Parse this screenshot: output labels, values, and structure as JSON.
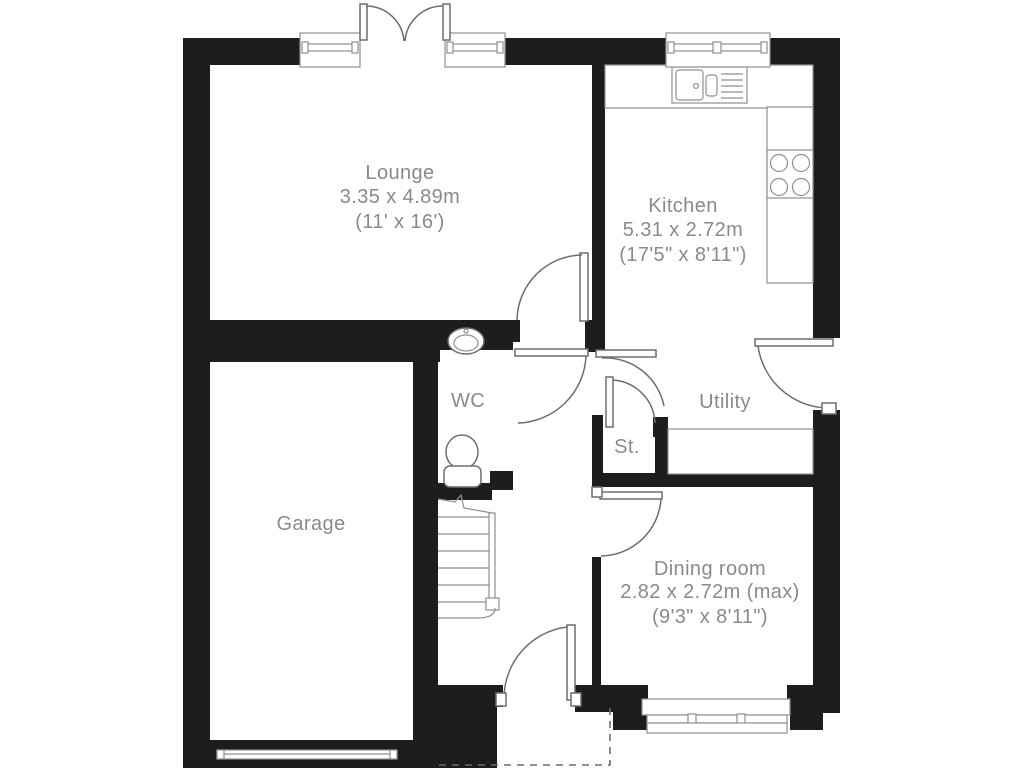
{
  "plan": {
    "rooms": {
      "lounge": {
        "name": "Lounge",
        "dimensions_metric": "3.35 x 4.89m",
        "dimensions_imperial": "(11' x 16')"
      },
      "kitchen": {
        "name": "Kitchen",
        "dimensions_metric": "5.31 x 2.72m",
        "dimensions_imperial": "(17'5\" x 8'11\")"
      },
      "wc": {
        "name": "WC"
      },
      "utility": {
        "name": "Utility"
      },
      "store": {
        "name": "St."
      },
      "garage": {
        "name": "Garage"
      },
      "dining_room": {
        "name": "Dining room",
        "dimensions_metric": "2.82 x 2.72m (max)",
        "dimensions_imperial": "(9'3\" x 8'11\")"
      }
    },
    "colors": {
      "wall": "#1d1d1f",
      "line": "#6d6d71",
      "label": "#8a8a8c",
      "background": "#ffffff"
    }
  }
}
